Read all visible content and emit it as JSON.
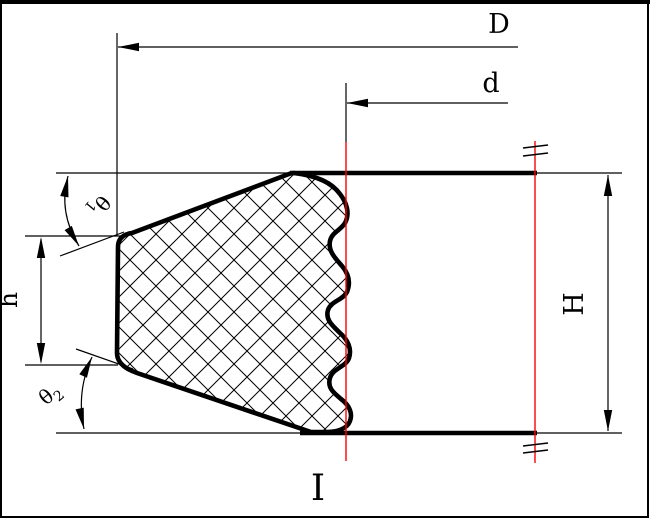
{
  "drawing": {
    "type": "seal-cross-section",
    "section_label": "I",
    "dimensions": {
      "outer_diameter": {
        "label": "D"
      },
      "inner_diameter": {
        "label": "d"
      },
      "total_height": {
        "label": "H"
      },
      "lip_height": {
        "label": "h"
      },
      "top_angle": {
        "symbol": "θ",
        "sub": "1"
      },
      "bottom_angle": {
        "symbol": "θ",
        "sub": "2"
      }
    },
    "colors": {
      "line": "#000000",
      "centerline": "#ff0000",
      "background": "#ffffff"
    }
  }
}
